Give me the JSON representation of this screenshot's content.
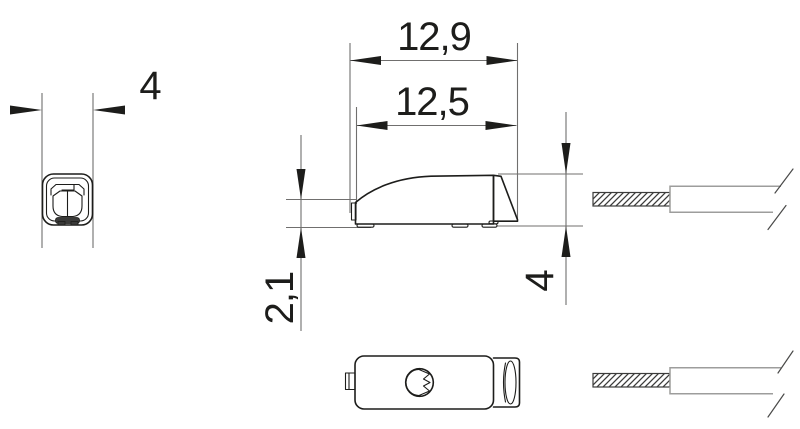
{
  "drawing": {
    "dimensions": {
      "front_width": "4",
      "overall_length": "12,9",
      "body_length": "12,5",
      "front_edge_height": "2,1",
      "rear_height": "4"
    },
    "colors": {
      "object_line": "#1d1d1b",
      "dimension_line": "#706f6e",
      "cable_outline": "#9d9d9c",
      "hatch_line": "#3c3c3b",
      "background": "#ffffff"
    }
  }
}
